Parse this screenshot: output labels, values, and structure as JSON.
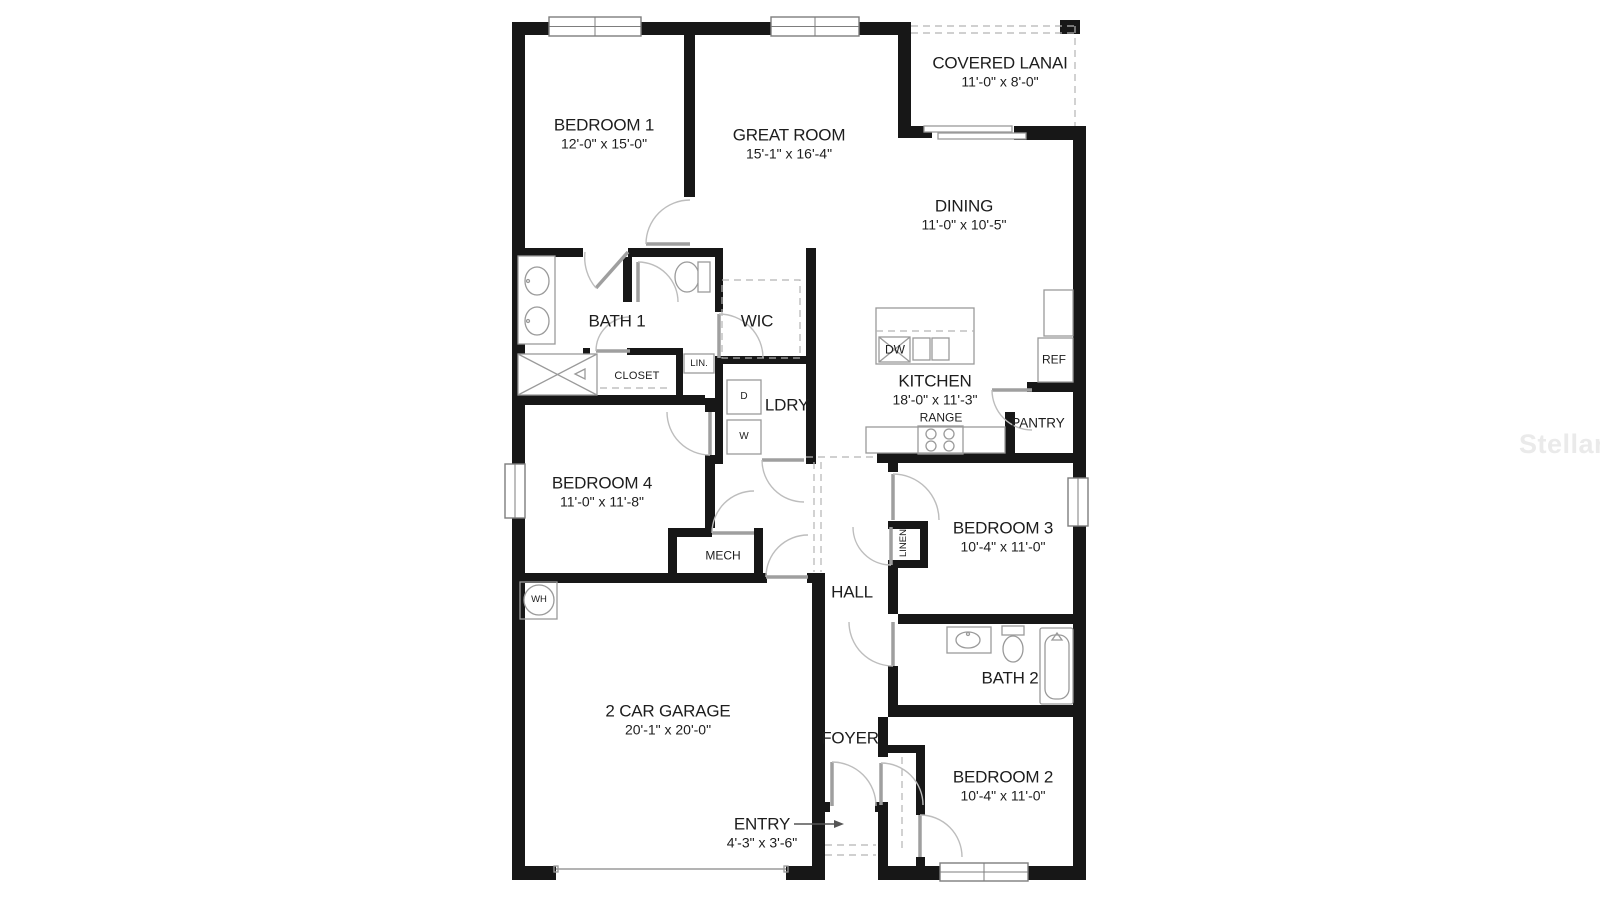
{
  "watermark": {
    "text": "StellarMLS"
  },
  "rooms": {
    "bedroom1": {
      "name": "BEDROOM 1",
      "dims": "12'-0\" x 15'-0\""
    },
    "great_room": {
      "name": "GREAT ROOM",
      "dims": "15'-1\" x 16'-4\""
    },
    "covered_lanai": {
      "name": "COVERED LANAI",
      "dims": "11'-0\" x 8'-0\""
    },
    "dining": {
      "name": "DINING",
      "dims": "11'-0\" x 10'-5\""
    },
    "kitchen": {
      "name": "KITCHEN",
      "dims": "18'-0\" x 11'-3\""
    },
    "bath1": {
      "name": "BATH 1"
    },
    "wic": {
      "name": "WIC"
    },
    "ldry": {
      "name": "LDRY"
    },
    "bedroom4": {
      "name": "BEDROOM 4",
      "dims": "11'-0\" x 11'-8\""
    },
    "bedroom3": {
      "name": "BEDROOM 3",
      "dims": "10'-4\" x 11'-0\""
    },
    "bedroom2": {
      "name": "BEDROOM 2",
      "dims": "10'-4\" x 11'-0\""
    },
    "bath2": {
      "name": "BATH 2"
    },
    "garage": {
      "name": "2 CAR GARAGE",
      "dims": "20'-1\" x 20'-0\""
    },
    "hall": {
      "name": "HALL"
    },
    "foyer": {
      "name": "FOYER"
    },
    "entry": {
      "name": "ENTRY",
      "dims": "4'-3\" x 3'-6\""
    }
  },
  "features": {
    "closet": "CLOSET",
    "lin": "LIN.",
    "linen": "LINEN",
    "mech": "MECH",
    "wh": "WH",
    "dryer": "D",
    "washer": "W",
    "dw": "DW",
    "ref": "REF",
    "range": "RANGE",
    "pantry": "PANTRY"
  }
}
